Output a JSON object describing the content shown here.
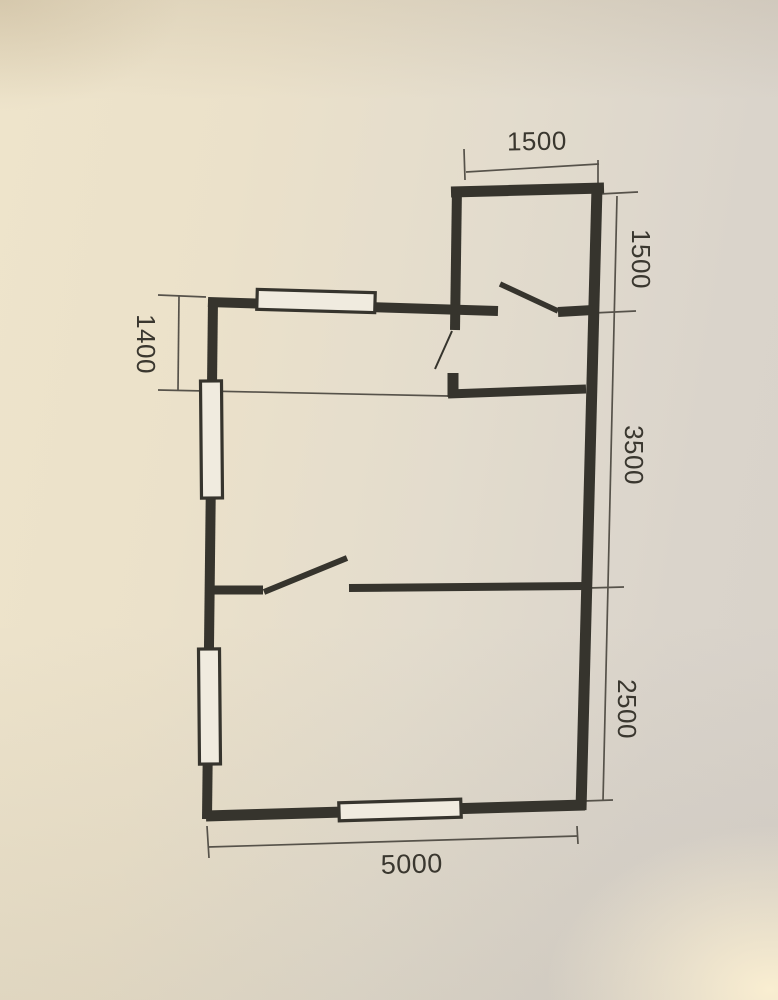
{
  "floor_plan": {
    "dimension_labels": {
      "top_width": "1500",
      "right_upper_height": "1500",
      "right_middle_height": "3500",
      "right_lower_height": "2500",
      "bottom_width": "5000",
      "left_upper_height": "1400"
    },
    "colors": {
      "ink": "#36342d",
      "dim_line": "#56524a",
      "paper_warm": "#eee4cb",
      "paper_cool": "#d8d2ca",
      "window_fill": "#f0ebdf"
    }
  }
}
